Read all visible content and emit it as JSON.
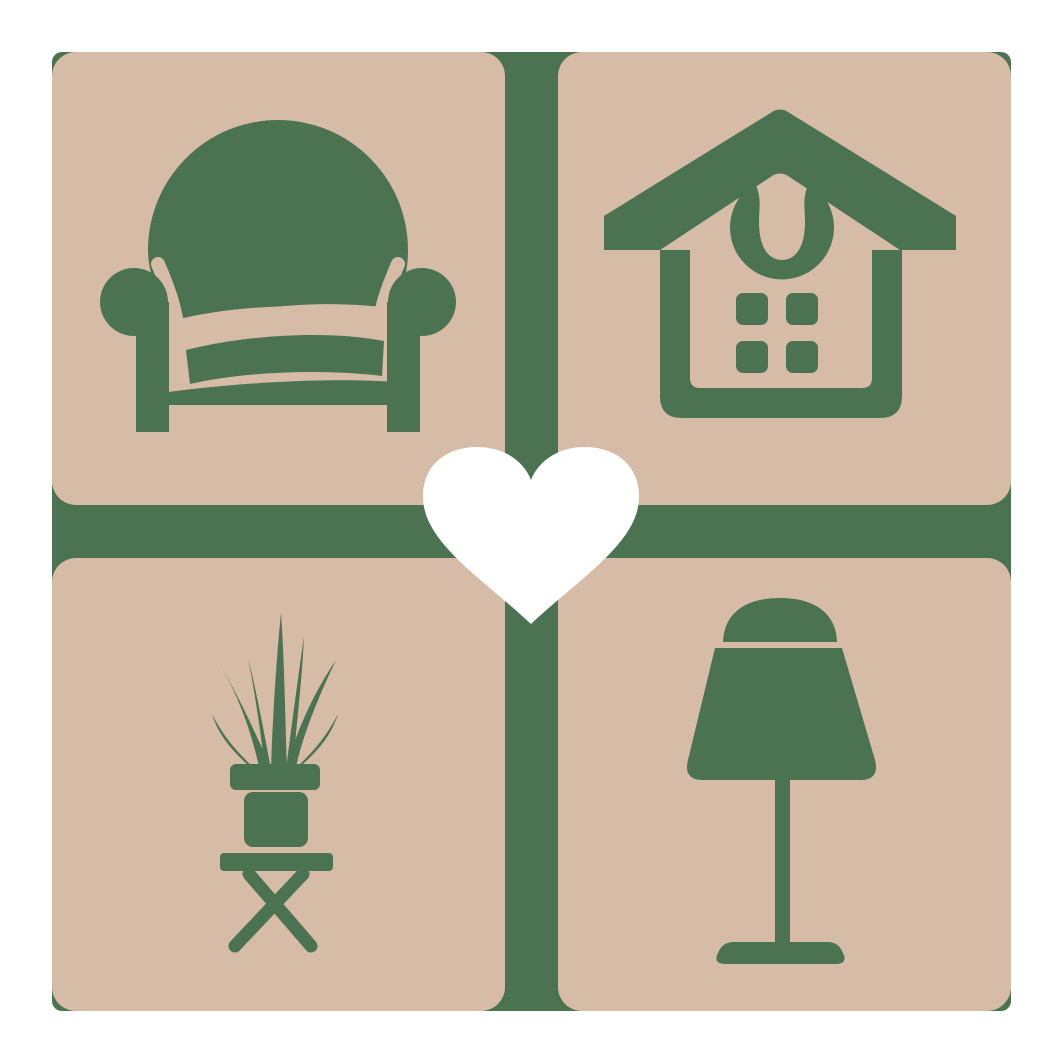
{
  "logo": {
    "description": "Home decor and furniture logo: four tan rounded tiles with green furniture silhouettes arranged in a 2x2 grid on a green backdrop, joined by a white heart in the center",
    "grid": {
      "rows": 2,
      "columns": 2
    },
    "tiles": [
      {
        "position": "top-left",
        "icon": "armchair-icon",
        "subject": "armchair"
      },
      {
        "position": "top-right",
        "icon": "house-icon",
        "subject": "house with four-pane window and arched ornament"
      },
      {
        "position": "bottom-left",
        "icon": "potted-plant-icon",
        "subject": "spiky potted plant on a cross-legged stool"
      },
      {
        "position": "bottom-right",
        "icon": "table-lamp-icon",
        "subject": "table lamp with shade, stem and base"
      }
    ],
    "center": {
      "icon": "heart-icon",
      "subject": "heart"
    },
    "colors": {
      "page_background": "#ffffff",
      "backdrop_green": "#4b7352",
      "tile_tan": "#d6bca7",
      "heart_white": "#ffffff"
    }
  }
}
